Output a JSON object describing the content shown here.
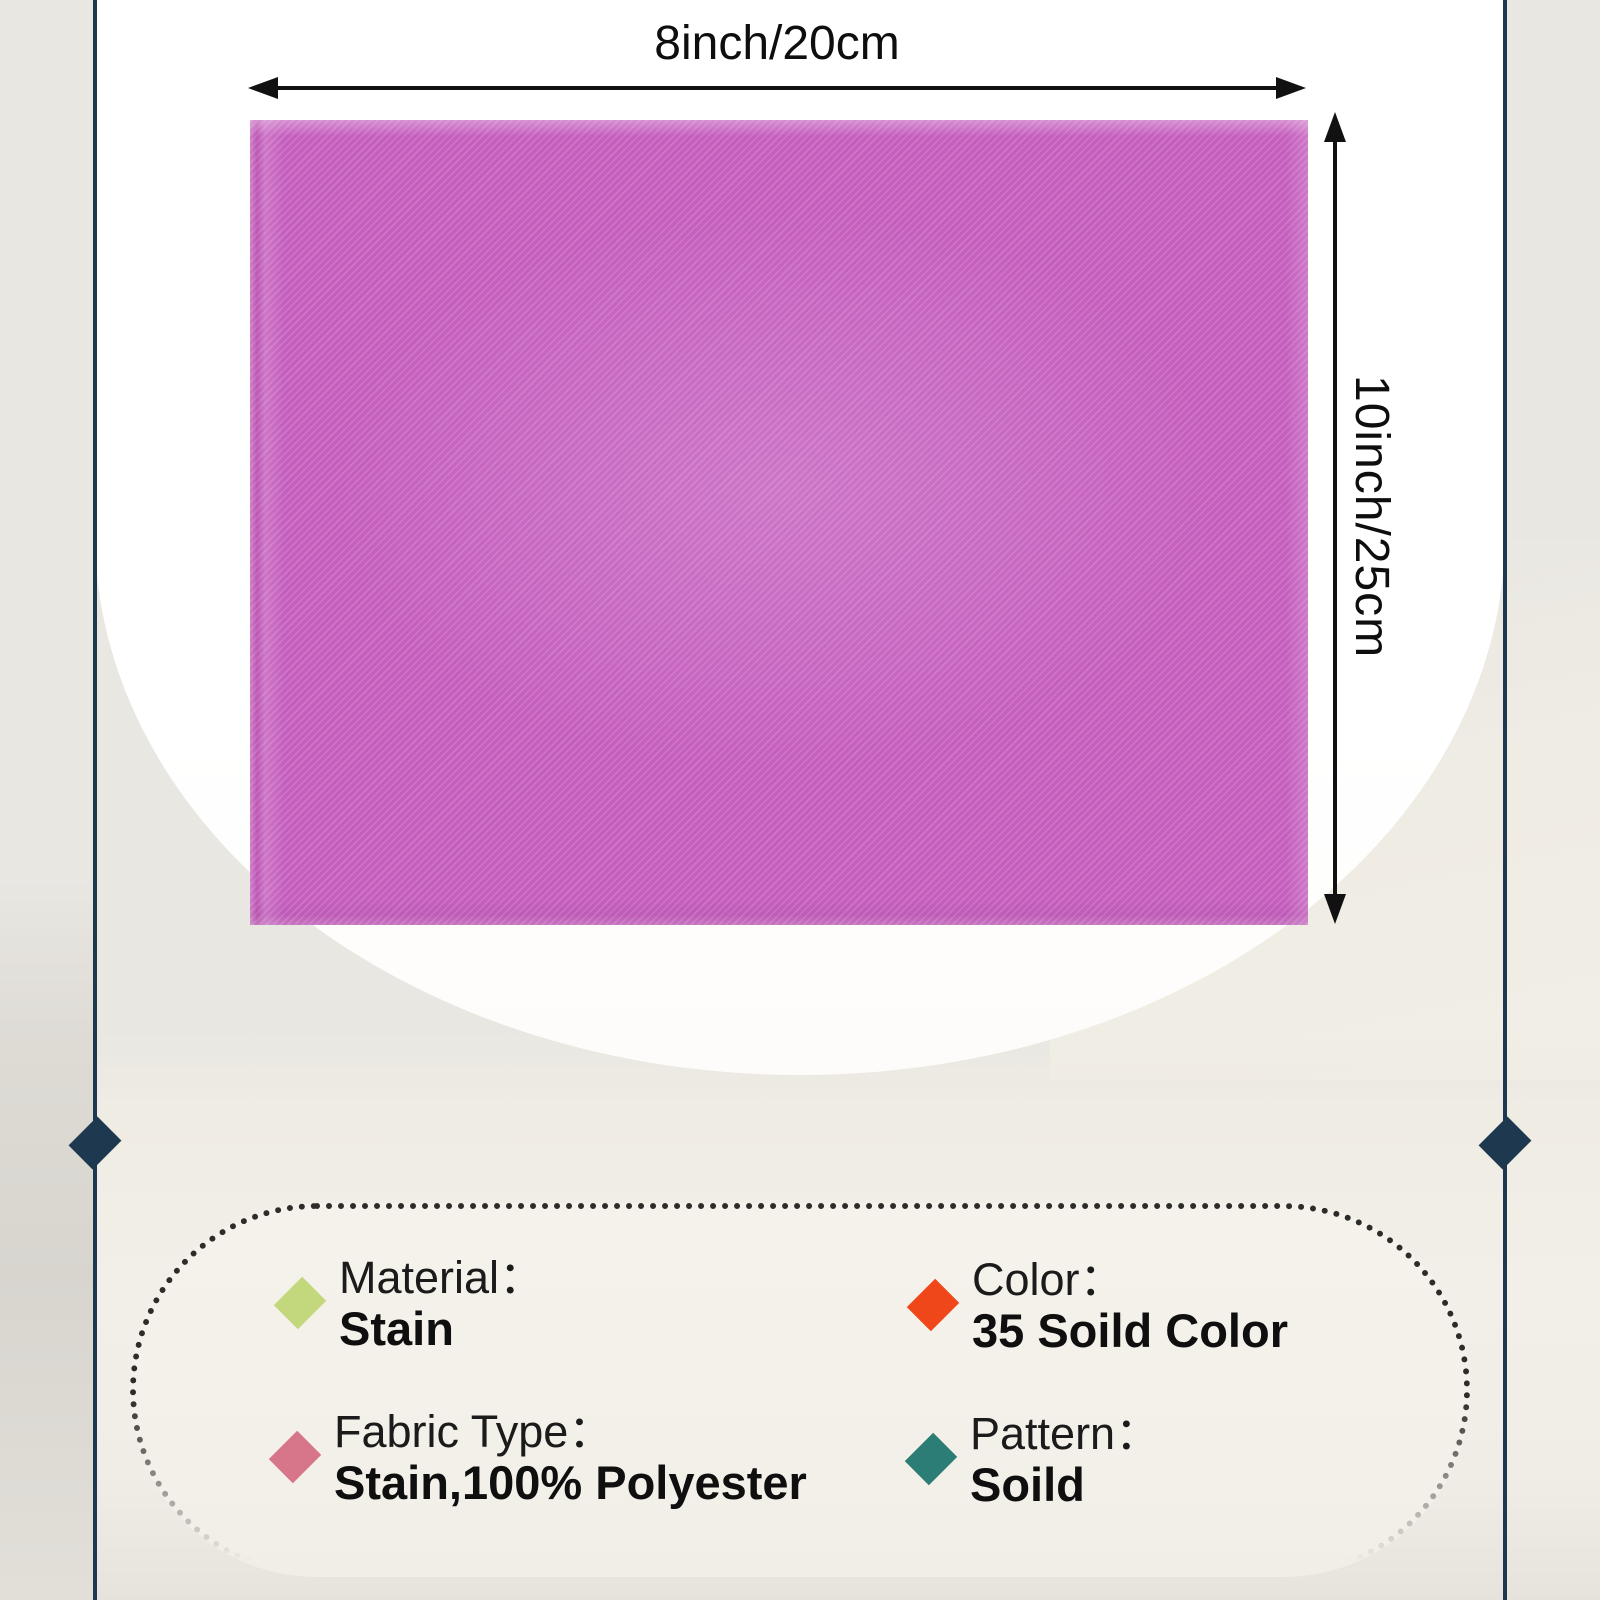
{
  "product_diagram": {
    "width_label": "8inch/20cm",
    "height_label": "10inch/25cm",
    "fabric_color": "#c55fbe"
  },
  "specs": {
    "items": [
      {
        "label": "Material：",
        "value": "Stain",
        "diamond_color": "#c3d87c"
      },
      {
        "label": "Color：",
        "value": "35 Soild Color",
        "diamond_color": "#f0471a"
      },
      {
        "label": "Fabric Type：",
        "value": "Stain,100% Polyester",
        "diamond_color": "#d7758b"
      },
      {
        "label": "Pattern：",
        "value": "Soild",
        "diamond_color": "#2c7d76"
      }
    ]
  },
  "colors": {
    "accent_navy": "#1d384f",
    "arrow_black": "#111111",
    "panel_cream": "#f3f0e9",
    "background_cream": "#efece4"
  }
}
